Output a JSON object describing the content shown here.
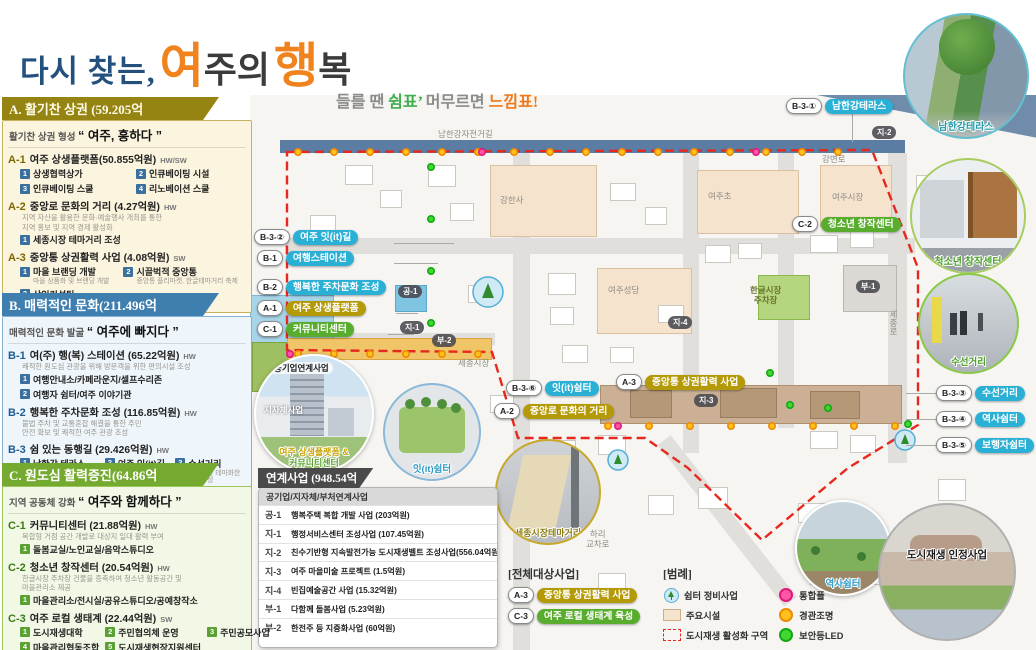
{
  "title": {
    "prefix": "다시 찾는,",
    "big": [
      {
        "t": "여"
      },
      {
        "t": "주의"
      },
      {
        "t": "행"
      },
      {
        "t": "복"
      }
    ],
    "subtitle": {
      "p1": "들를 땐",
      "p2": "쉼표’",
      "p3": "머무르면",
      "p4": "느낌표!"
    }
  },
  "panels": {
    "a": {
      "header": "A. 활기찬 상권 (59.205억",
      "tagline_label": "활기찬 상권 형성",
      "tagline_quote": "“ 여주, 흥하다 ”",
      "entries": [
        {
          "code": "A-1",
          "title": "여주 상생플랫폼(50.855억원)",
          "tag": "HW/SW",
          "cols": 2,
          "subs": [
            {
              "n": "1",
              "label": "상생협력상가"
            },
            {
              "n": "2",
              "label": "인큐베이팅 시설"
            },
            {
              "n": "3",
              "label": "인큐베이팅 스쿨"
            },
            {
              "n": "4",
              "label": "리노베이션 스쿨"
            }
          ]
        },
        {
          "code": "A-2",
          "title": "중앙로 문화의 거리 (4.27억원)",
          "tag": "HW",
          "cols": 1,
          "desc": [
            "지역 자산을 활용한 문화·예술행사 개최를 통한",
            "지역 홍보 및 지역 경제 활성화"
          ],
          "subs": [
            {
              "n": "1",
              "label": "세종시장 테마거리 조성"
            }
          ]
        },
        {
          "code": "A-3",
          "title": "중앙통 상권활력 사업 (4.08억원)",
          "tag": "SW",
          "cols": 2,
          "subs": [
            {
              "n": "1",
              "label": "마을 브랜딩 개발",
              "desc": [
                "마을 상품화 및 브랜딩 개발"
              ]
            },
            {
              "n": "2",
              "label": "시끌벅적 중앙통",
              "desc": [
                "중앙통 플리마켓, 한글테마거리 축제"
              ]
            },
            {
              "n": "3",
              "label": "상인컨설팅",
              "desc": [
                "상인 서비스 교육"
              ]
            }
          ]
        }
      ]
    },
    "b": {
      "header": "B. 매력적인 문화(211.496억",
      "tagline_label": "매력적인 문화 발굴",
      "tagline_quote": "“ 여주에 빠지다 ”",
      "entries": [
        {
          "code": "B-1",
          "title": "여(주) 행(복) 스테이션 (65.22억원)",
          "tag": "HW",
          "cols": 1,
          "desc": [
            "쾌적한 원도심 관광을 위해 방문객을 위한 편의시설 조성"
          ],
          "subs": [
            {
              "n": "1",
              "label": "여행안내소/카페라운지/셀프수리존"
            },
            {
              "n": "2",
              "label": "여행자 쉼터/여주 이야기관"
            }
          ]
        },
        {
          "code": "B-2",
          "title": "행복한 주차문화 조성 (116.85억원)",
          "tag": "HW",
          "cols": 1,
          "desc": [
            "불법 주차 및 교통혼잡 해결을 통한 주민",
            "안전 확보 및 쾌적한 여주 관광 조성"
          ],
          "subs": []
        },
        {
          "code": "B-3",
          "title": "쉼 있는 동행길 (29.426억원)",
          "tag": "HW",
          "cols": 3,
          "subs": [
            {
              "n": "1",
              "label": "남한강 테라스",
              "desc": [
                "남한강 조망 데크 확장",
                "및 디자인벤치 조성"
              ]
            },
            {
              "n": "2",
              "label": "여주 잇(it)길",
              "desc": [
                "제일시장 옆길",
                "거리 정비"
              ]
            },
            {
              "n": "3",
              "label": "수선거리",
              "desc": [
                "수선업을 테마화한",
                "거리조성"
              ]
            },
            {
              "n": "4",
              "label": "역사쉼터",
              "desc": [
                "순교터를 활용한",
                "역사쉼터 조성"
              ]
            },
            {
              "n": "5",
              "label": "보행자쉼터",
              "desc": [
                "자투리땅을",
                "활용한 쉼터 조성"
              ]
            },
            {
              "n": "6",
              "label": "잇(it)쉼터",
              "desc": [
                "파고라 및 한글벤치",
                "제작·배치"
              ]
            }
          ]
        }
      ]
    },
    "c": {
      "header": "C. 원도심 활력증진(64.86억",
      "tagline_label": "지역 공동체 강화",
      "tagline_quote": "“ 여주와 함께하다 ”",
      "entries": [
        {
          "code": "C-1",
          "title": "커뮤니티센터 (21.88억원)",
          "tag": "HW",
          "cols": 1,
          "desc": [
            "복합형 거점 공간 개발로 대상지 일대 활력 부여"
          ],
          "subs": [
            {
              "n": "1",
              "label": "돌봄교실/노인교실/음악스튜디오"
            }
          ]
        },
        {
          "code": "C-2",
          "title": "청소년 창작센터 (20.54억원)",
          "tag": "HW",
          "cols": 1,
          "desc": [
            "한글시장 주차장 건물을 증축하여 청소년 활동공간 및",
            "마을관리소 제공"
          ],
          "subs": [
            {
              "n": "1",
              "label": "마을관리소/전시실/공유스튜디오/공예창작소"
            }
          ]
        },
        {
          "code": "C-3",
          "title": "여주 로컬 생태계 (22.44억원)",
          "tag": "SW",
          "cols": 3,
          "subs": [
            {
              "n": "1",
              "label": "도시재생대학"
            },
            {
              "n": "2",
              "label": "주민협의체 운영"
            },
            {
              "n": "3",
              "label": "주민공모사업"
            },
            {
              "n": "4",
              "label": "마을관리협동조합"
            },
            {
              "n": "5",
              "label": "도시재생현장지원센터"
            }
          ]
        }
      ]
    }
  },
  "map": {
    "river": "남한강",
    "bike_path": "남한강자전거길",
    "roads": {
      "gangbyeon": "강변로",
      "sejong": "세종로"
    },
    "places": {
      "school": "여주초",
      "market": "여주시장",
      "temple": "강한사",
      "cathedral": "여주성당",
      "hangeul_parking": "한글시장\n주차장",
      "sejong_market": "세종시장",
      "hari": "하리\n교차로"
    },
    "zones": {
      "gong1": "공-1",
      "ji1": "지-1",
      "ji2": "지-2",
      "ji3": "지-3",
      "ji4": "지-4",
      "bu1": "부-1",
      "bu2": "부-2"
    },
    "pills": [
      {
        "prefix": "B-3-②",
        "label": "여주 잇(it)길",
        "color": "blue"
      },
      {
        "prefix": "B-1",
        "label": "여행스테이션",
        "color": "blue"
      },
      {
        "prefix": "B-2",
        "label": "행복한 주차문화 조성",
        "color": "blue"
      },
      {
        "prefix": "A-1",
        "label": "여주 상생플랫폼",
        "color": "gold"
      },
      {
        "prefix": "C-1",
        "label": "커뮤니티센터",
        "color": "green"
      },
      {
        "prefix": "B-3-⑥",
        "label": "잇(it)쉼터",
        "color": "blue"
      },
      {
        "prefix": "A-2",
        "label": "중앙로 문화의 거리",
        "color": "gold"
      },
      {
        "prefix": "A-3",
        "label": "중앙통 상권활력 사업",
        "color": "gold"
      },
      {
        "prefix": "B-3-①",
        "label": "남한강테라스",
        "color": "blue"
      },
      {
        "prefix": "C-2",
        "label": "청소년 창작센터",
        "color": "green"
      },
      {
        "prefix": "B-3-③",
        "label": "수선거리",
        "color": "blue"
      },
      {
        "prefix": "B-3-④",
        "label": "역사쉼터",
        "color": "blue"
      },
      {
        "prefix": "B-3-⑤",
        "label": "보행자쉼터",
        "color": "blue"
      }
    ]
  },
  "insets": {
    "namhangang": "남한강테라스",
    "youth": "청소년 창작센터",
    "suseon": "수선거리",
    "injeong": "도시재생 인정사업",
    "platform_top": "공기업연계사업",
    "platform_mid": "지자체사업",
    "platform_cap1": "여주 상생플랫폼 &",
    "platform_cap2": "커뮤니티센터",
    "it_shelter": "잇(it)쉼터",
    "sejong_theme": "세종시장테마거리",
    "history": "역사쉼터"
  },
  "linked": {
    "header": "연계사업 (948.54억",
    "subheader": "공기업/지자체/부처연계사업",
    "rows": [
      {
        "code": "공-1",
        "label": "행복주택 복합 개발 사업 (203억원)"
      },
      {
        "code": "지-1",
        "label": "행정서비스센터 조성사업 (107.45억원)"
      },
      {
        "code": "지-2",
        "label": "친수기반형 지속발전가능 도시재생벨트 조성사업(556.04억원)"
      },
      {
        "code": "지-3",
        "label": "여주 마을미술 프로젝트 (1.5억원)"
      },
      {
        "code": "지-4",
        "label": "빈집예술공간 사업 (15.32억원)"
      },
      {
        "code": "부-1",
        "label": "다함께 돌봄사업 (5.23억원)"
      },
      {
        "code": "부-2",
        "label": "한전주 등 지중화사업 (60억원)"
      }
    ]
  },
  "target_all": {
    "title": "[전체대상사업]",
    "items": [
      {
        "code": "A-3",
        "label": "중앙통 상권활력 사업",
        "color": "gold"
      },
      {
        "code": "C-3",
        "label": "여주 로컬 생태계 육성",
        "color": "green"
      }
    ]
  },
  "legend": {
    "title": "[범례]",
    "left": [
      {
        "icon": "shelter-icon",
        "label": "쉼터 정비사업"
      },
      {
        "icon": "facility-icon",
        "label": "주요시설"
      },
      {
        "icon": "district-icon",
        "label": "도시재생 활성화 구역"
      }
    ],
    "right": [
      {
        "dot": "#ff56a5",
        "ring": "#e0187c",
        "label": "통합폴"
      },
      {
        "dot": "#ffc11e",
        "ring": "#f08a00",
        "label": "경관조명"
      },
      {
        "dot": "#42d733",
        "ring": "#12a812",
        "label": "보안등LED"
      }
    ]
  },
  "colors": {
    "accent_orange": "#f0831e",
    "navy": "#24507e",
    "pill_blue": "#2ab0d5",
    "pill_gold": "#b49a06",
    "pill_green": "#58ad2e",
    "header_a": "#958411",
    "header_b": "#3e7fb0",
    "header_c": "#74aa2f",
    "boundary_red": "#e8281e"
  }
}
